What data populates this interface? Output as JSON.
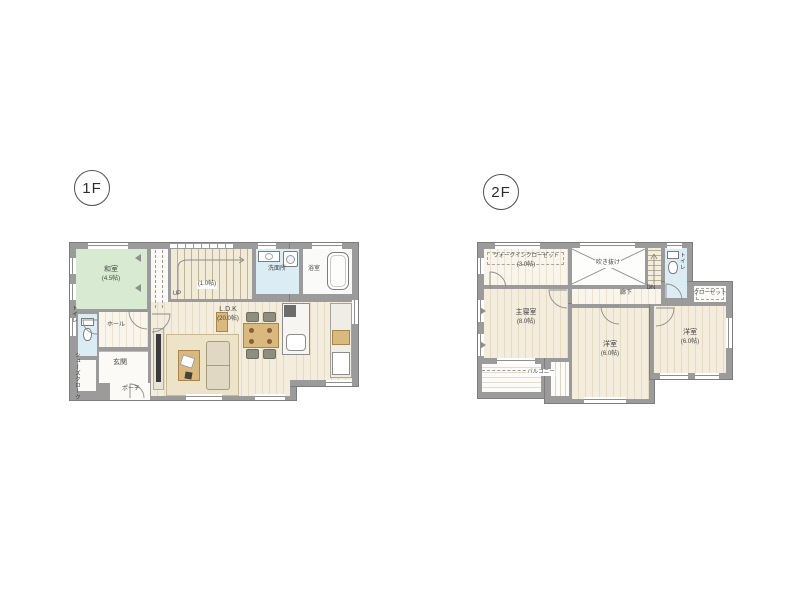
{
  "floor1": {
    "badge": "1F",
    "rooms": {
      "washitsu": {
        "label": "和室",
        "size": "(4.5帖)"
      },
      "stairs": {
        "size": "(1.0帖)",
        "direction": "UP"
      },
      "senmenjo": {
        "label": "洗面所"
      },
      "yokushitsu": {
        "label": "浴室"
      },
      "ldk": {
        "label": "L.D.K",
        "size": "(20.0帖)"
      },
      "hall": {
        "label": "ホール"
      },
      "toilet": {
        "label": "トイレ"
      },
      "genkan": {
        "label": "玄関"
      },
      "shoes_cloak": {
        "label": "シューズクローク"
      },
      "porch": {
        "label": "ポーチ"
      }
    }
  },
  "floor2": {
    "badge": "2F",
    "rooms": {
      "wic": {
        "label": "ウォークインクローゼット",
        "size": "(3.0帖)"
      },
      "void": {
        "label": "吹き抜け"
      },
      "stairs": {
        "direction": "DN"
      },
      "toilet": {
        "label": "トイレ"
      },
      "closet": {
        "label": "クローゼット"
      },
      "master_bedroom": {
        "label": "主寝室",
        "size": "(8.0帖)"
      },
      "hallway": {
        "label": "廊下"
      },
      "bedroom_center": {
        "label": "洋室",
        "size": "(6.0帖)"
      },
      "bedroom_right": {
        "label": "洋室",
        "size": "(6.0帖)"
      },
      "balcony": {
        "label": "バルコニー"
      }
    }
  },
  "colors": {
    "wall": "#9b9b9b",
    "tatami": "#d8ead1",
    "wood": "#f3ecdb",
    "water": "#dcecf4",
    "furniture": "#d9b97d",
    "sofa": "#e0d8c2",
    "rug": "#ece3c9"
  }
}
